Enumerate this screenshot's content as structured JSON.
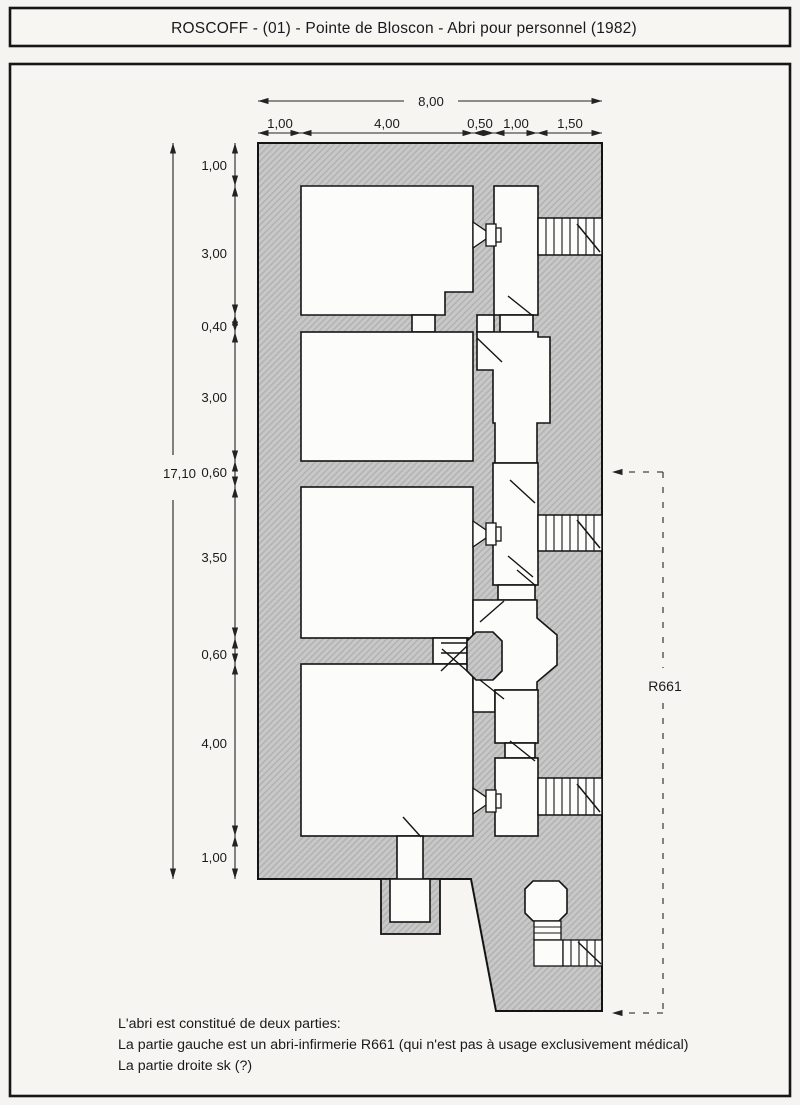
{
  "title": "ROSCOFF - (01) - Pointe de Bloscon - Abri pour personnel (1982)",
  "plan": {
    "zone_label": "R661",
    "dims": {
      "top_total": "8,00",
      "top_segments": [
        "1,00",
        "4,00",
        "0,50",
        "1,00",
        "1,50"
      ],
      "left_total": "17,10",
      "left_segments": [
        "1,00",
        "3,00",
        "0,40",
        "3,00",
        "0,60",
        "3,50",
        "0,60",
        "4,00",
        "1,00"
      ]
    }
  },
  "caption": {
    "line1": "L'abri est constitué de deux parties:",
    "line2": "La partie gauche est un abri-infirmerie R661 (qui n'est pas à usage exclusivement médical)",
    "line3": "La partie droite sk (?)"
  },
  "colors": {
    "paper": "#f5f4f1",
    "wall_fill": "#c8c8c8",
    "wall_hatch": "#b2b2b2",
    "ink": "#1a1a1a",
    "dim_line": "#222222"
  }
}
